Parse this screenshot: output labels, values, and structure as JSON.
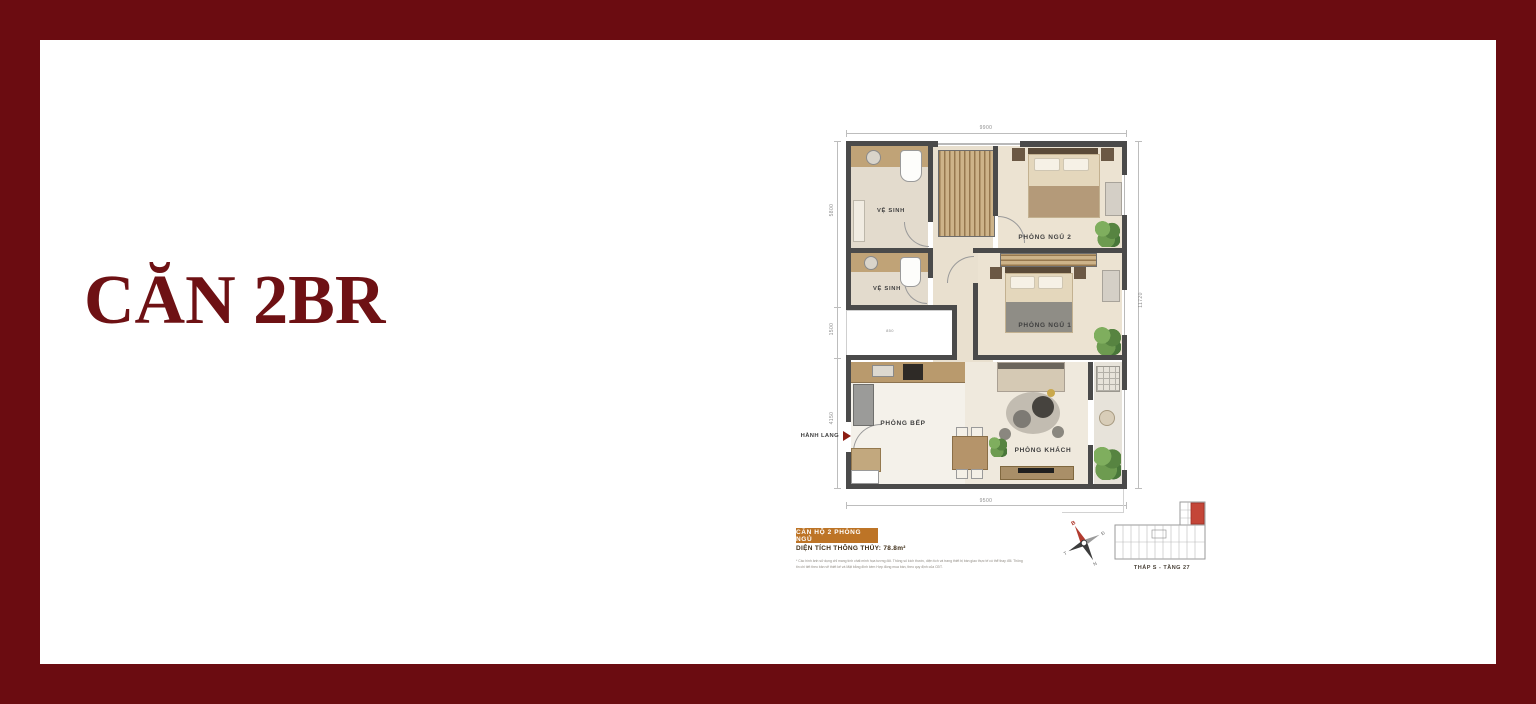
{
  "frame": {
    "border_color": "#6b0c11"
  },
  "title": "CĂN 2BR",
  "plan": {
    "rooms": {
      "bath1": "VỆ SINH",
      "bath2": "VỆ SINH",
      "bedroom2": "PHÒNG NGỦ 2",
      "bedroom1": "PHÒNG NGỦ 1",
      "kitchen": "PHÒNG BẾP",
      "living": "PHÒNG KHÁCH"
    },
    "corridor_label": "HÀNH LANG",
    "niche_label": "850",
    "dimensions": {
      "top": "9900",
      "bottom": "9500",
      "left_upper": "5800",
      "left_middle": "1500",
      "left_lower": "4150",
      "right": "11720"
    }
  },
  "info": {
    "badge": "CĂN HỘ 2 PHÒNG NGỦ",
    "area": "DIỆN TÍCH THÔNG THỦY: 78.8m²",
    "disclaimer_line1": "* Các hình ảnh sử dụng chỉ mang tính chất minh họa tương đối. Thông số kích thước, diện tích và trang thiết bị bàn giao thực tế có thể thay đổi. Thông",
    "disclaimer_line2": "tin chi tiết theo bản vẽ thiết kế và Mặt bằng đính kèm Hợp đồng mua bán, theo quy định của CĐT."
  },
  "keyplan": {
    "caption": "THÁP S - TẦNG 27"
  },
  "compass": {
    "north": "B",
    "east": "Đ",
    "south": "N",
    "west": "T"
  }
}
